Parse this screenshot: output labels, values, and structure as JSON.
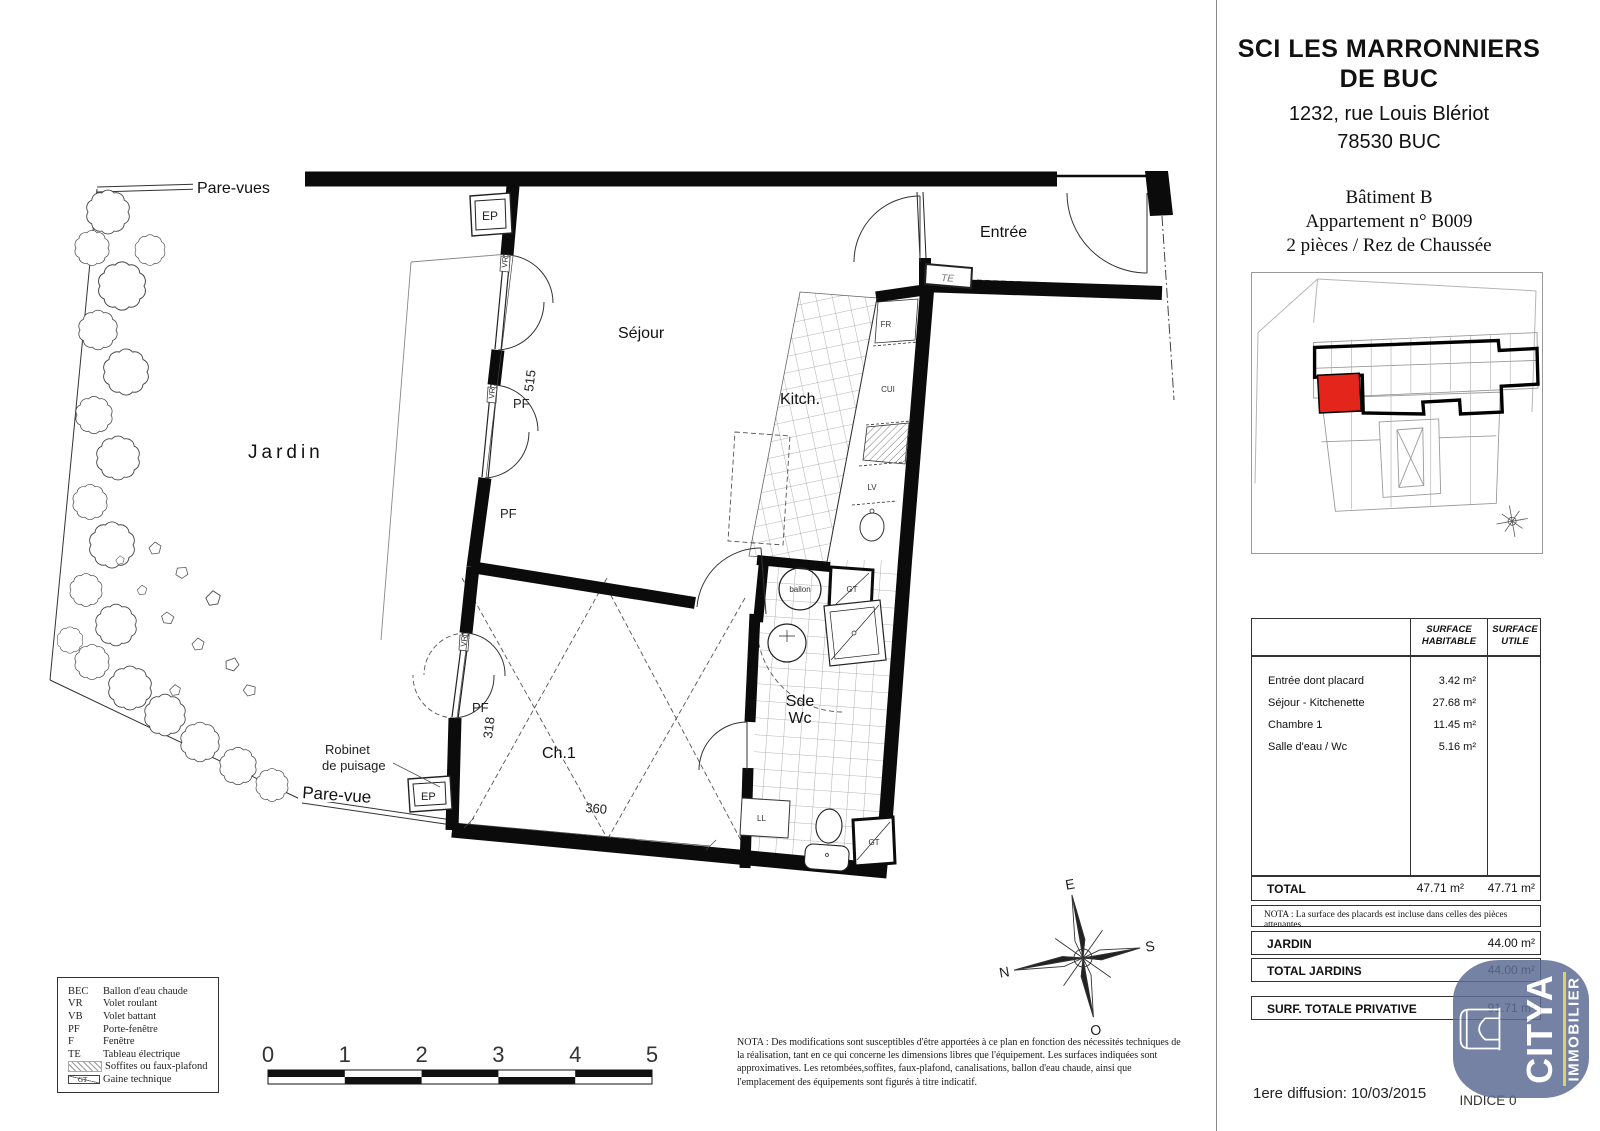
{
  "header": {
    "company_line1": "SCI LES MARRONNIERS",
    "company_line2": "DE BUC",
    "address_line1": "1232, rue Louis Blériot",
    "address_line2": "78530 BUC",
    "building": "Bâtiment B",
    "apartment": "Appartement n° B009",
    "unit_type": "2 pièces / Rez de Chaussée"
  },
  "surface_table": {
    "col_habitable": "SURFACE HABITABLE",
    "col_utile": "SURFACE UTILE",
    "rows": [
      {
        "label": "Entrée dont placard",
        "habitable": "3.42 m²"
      },
      {
        "label": "Séjour - Kitchenette",
        "habitable": "27.68 m²"
      },
      {
        "label": "Chambre 1",
        "habitable": "11.45 m²"
      },
      {
        "label": "Salle d'eau / Wc",
        "habitable": "5.16 m²"
      }
    ],
    "total_label": "TOTAL",
    "total_habitable": "47.71 m²",
    "total_utile": "47.71 m²",
    "nota": "NOTA : La surface des placards est incluse dans celles des pièces attenantes.",
    "jardin_label": "JARDIN",
    "jardin_value": "44.00 m²",
    "total_jardins_label": "TOTAL JARDINS",
    "total_jardins_value": "44.00 m²",
    "privative_label": "SURF. TOTALE PRIVATIVE",
    "privative_value": "91.71 m²"
  },
  "plan": {
    "rooms": {
      "jardin": "Jardin",
      "sejour": "Séjour",
      "kitchen": "Kitch.",
      "entree": "Entrée",
      "chambre": "Ch.1",
      "sde": "Sde",
      "wc": "Wc"
    },
    "labels": {
      "pare_vues": "Pare-vues",
      "pare_vue": "Pare-vue",
      "robinet_line1": "Robinet",
      "robinet_line2": "de puisage",
      "ep": "EP",
      "te": "TE",
      "fr": "FR",
      "cui": "CUI",
      "lv": "LV",
      "gt": "GT",
      "ballon": "ballon",
      "ll": "LL",
      "vr": "VR",
      "pf": "PF"
    },
    "dims": {
      "sejour_windows": "515",
      "chambre_window": "318",
      "chambre_width": "360"
    },
    "compass": {
      "n": "N",
      "e": "E",
      "s": "S",
      "o": "O"
    }
  },
  "legend": {
    "items": [
      {
        "abbr": "BEC",
        "label": "Ballon d'eau chaude"
      },
      {
        "abbr": "VR",
        "label": "Volet roulant"
      },
      {
        "abbr": "VB",
        "label": "Volet battant"
      },
      {
        "abbr": "PF",
        "label": "Porte-fenêtre"
      },
      {
        "abbr": "F",
        "label": "Fenêtre"
      },
      {
        "abbr": "TE",
        "label": "Tableau électrique"
      },
      {
        "abbr": "",
        "label": "Soffites ou faux-plafond"
      },
      {
        "abbr": "GT",
        "label": "Gaine technique"
      }
    ]
  },
  "scalebar": {
    "ticks": [
      "0",
      "1",
      "2",
      "3",
      "4",
      "5"
    ]
  },
  "nota_bottom": "NOTA : Des modifications sont susceptibles d'être apportées à ce plan en fonction des nécessités techniques de la réalisation, tant en ce qui concerne les dimensions libres que l'équipement. Les surfaces indiquées sont approximatives. Les retombées,soffites, faux-plafond, canalisations, ballon d'eau chaude, ainsi que l'emplacement des équipements sont figurés à titre indicatif.",
  "footer": {
    "diffusion": "1ere diffusion: 10/03/2015",
    "indice": "INDICE 0"
  },
  "logo": {
    "name": "CITYA",
    "tagline": "IMMOBILIER"
  },
  "colors": {
    "unit_red": "#e3251c",
    "logo_blue": "#5d6d95",
    "logo_yellow": "#d9c94e"
  }
}
